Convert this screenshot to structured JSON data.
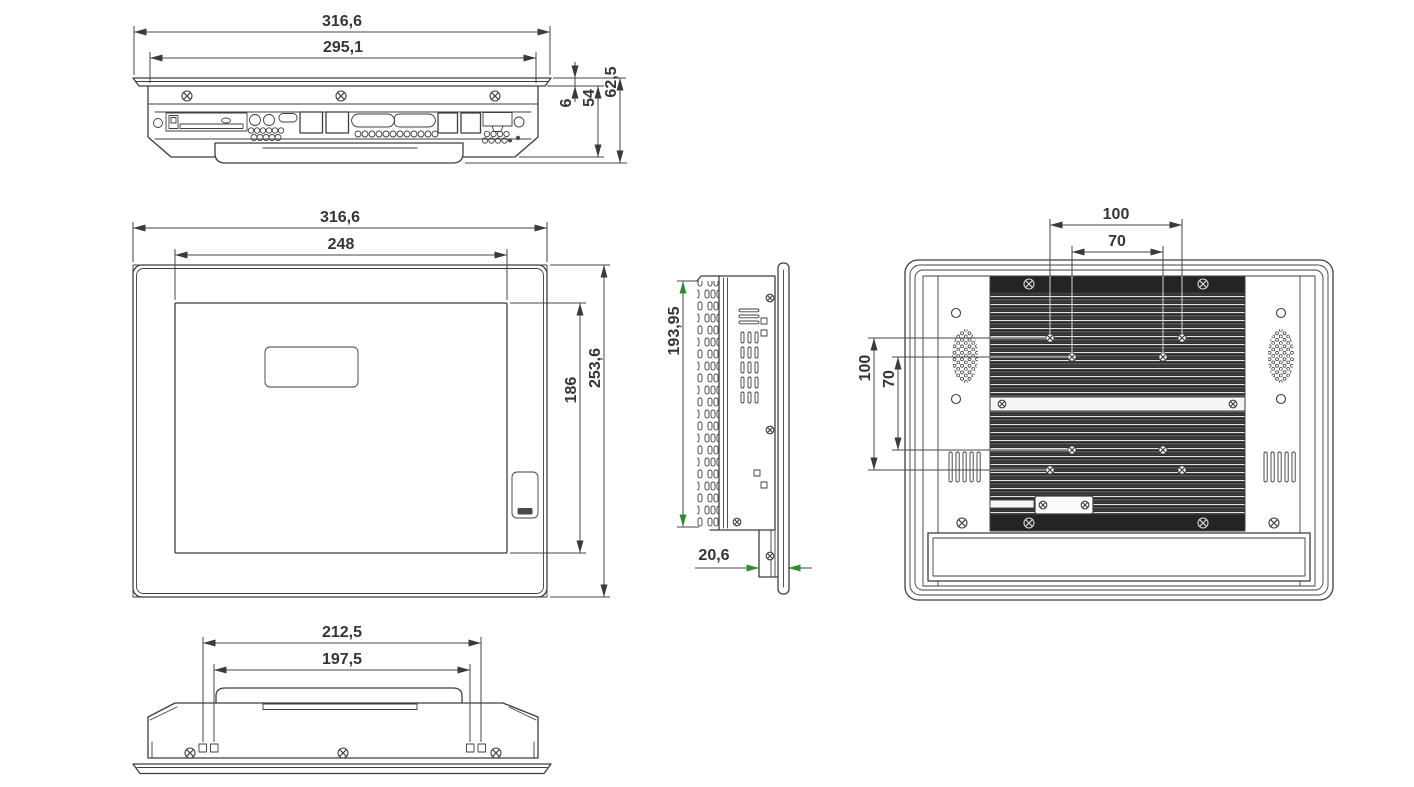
{
  "drawing": {
    "background": "#ffffff",
    "line_color": "#3f3f3f",
    "dimension_text_color": "#353535",
    "green_arrow_color": "#2e8b2e",
    "heatsink_dark_color": "#2e2e2e",
    "views": {
      "top_view": {
        "dims": {
          "overall_width": "316,6",
          "chassis_width": "295,1",
          "bezel_thickness": "6",
          "body_depth": "54",
          "overall_depth": "62,5"
        }
      },
      "front_view": {
        "dims": {
          "overall_width": "316,6",
          "display_width": "248",
          "display_height": "186",
          "overall_height": "253,6"
        }
      },
      "side_view": {
        "dims": {
          "cutout_height": "193,95",
          "rear_hood_depth": "20,6"
        }
      },
      "rear_view": {
        "dims": {
          "vesa_width_outer": "100",
          "vesa_width_inner": "70",
          "vesa_height_outer": "100",
          "vesa_height_inner": "70"
        }
      },
      "bottom_view": {
        "dims": {
          "bracket_outer_spacing": "212,5",
          "bracket_inner_spacing": "197,5"
        }
      }
    }
  }
}
